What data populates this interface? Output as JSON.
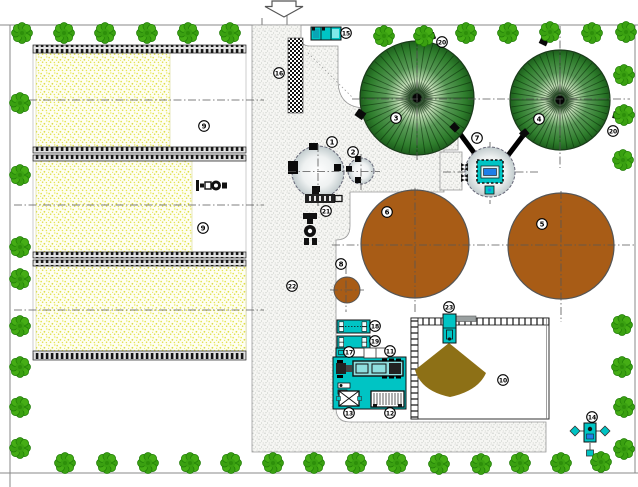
{
  "plan": {
    "title": "biogas-plant-site-plan",
    "entrance_arrow": {
      "icon": "down-arrow"
    },
    "markers": [
      {
        "n": "1",
        "x": 332,
        "y": 142
      },
      {
        "n": "2",
        "x": 353,
        "y": 152
      },
      {
        "n": "3",
        "x": 396,
        "y": 118
      },
      {
        "n": "4",
        "x": 539,
        "y": 119
      },
      {
        "n": "5",
        "x": 542,
        "y": 224
      },
      {
        "n": "6",
        "x": 387,
        "y": 212
      },
      {
        "n": "7",
        "x": 477,
        "y": 138
      },
      {
        "n": "8",
        "x": 341,
        "y": 264
      },
      {
        "n": "9",
        "x": 204,
        "y": 126
      },
      {
        "n": "9",
        "x": 203,
        "y": 228
      },
      {
        "n": "10",
        "x": 503,
        "y": 380
      },
      {
        "n": "11",
        "x": 390,
        "y": 351
      },
      {
        "n": "12",
        "x": 390,
        "y": 413
      },
      {
        "n": "13",
        "x": 349,
        "y": 413
      },
      {
        "n": "14",
        "x": 592,
        "y": 417
      },
      {
        "n": "15",
        "x": 346,
        "y": 33
      },
      {
        "n": "16",
        "x": 279,
        "y": 73
      },
      {
        "n": "17",
        "x": 349,
        "y": 352
      },
      {
        "n": "18",
        "x": 375,
        "y": 326
      },
      {
        "n": "19",
        "x": 375,
        "y": 341
      },
      {
        "n": "20",
        "x": 442,
        "y": 42
      },
      {
        "n": "20",
        "x": 613,
        "y": 131
      },
      {
        "n": "21",
        "x": 326,
        "y": 211
      },
      {
        "n": "22",
        "x": 292,
        "y": 286
      },
      {
        "n": "23",
        "x": 449,
        "y": 307
      }
    ],
    "digesters": [
      {
        "cx": 417,
        "cy": 98,
        "r": 57
      },
      {
        "cx": 560,
        "cy": 100,
        "r": 50
      }
    ],
    "trees": [
      [
        22,
        33
      ],
      [
        64,
        33
      ],
      [
        105,
        33
      ],
      [
        147,
        33
      ],
      [
        188,
        33
      ],
      [
        230,
        33
      ],
      [
        384,
        36
      ],
      [
        424,
        36
      ],
      [
        466,
        33
      ],
      [
        508,
        33
      ],
      [
        550,
        32
      ],
      [
        592,
        33
      ],
      [
        626,
        32
      ],
      [
        20,
        103
      ],
      [
        20,
        175
      ],
      [
        20,
        247
      ],
      [
        20,
        279
      ],
      [
        20,
        326
      ],
      [
        20,
        367
      ],
      [
        20,
        407
      ],
      [
        20,
        448
      ],
      [
        65,
        463
      ],
      [
        107,
        463
      ],
      [
        148,
        463
      ],
      [
        190,
        463
      ],
      [
        231,
        463
      ],
      [
        273,
        463
      ],
      [
        314,
        463
      ],
      [
        356,
        463
      ],
      [
        397,
        463
      ],
      [
        439,
        464
      ],
      [
        481,
        464
      ],
      [
        520,
        463
      ],
      [
        561,
        463
      ],
      [
        601,
        462
      ],
      [
        624,
        449
      ],
      [
        624,
        75
      ],
      [
        624,
        115
      ],
      [
        623,
        160
      ],
      [
        622,
        325
      ],
      [
        622,
        367
      ],
      [
        624,
        407
      ]
    ],
    "colors": {
      "tree_green": "#3aa011",
      "digester_green_dark": "#1d5e1c",
      "digester_green_light": "#c9e2bd",
      "tank_brown": "#a85c16",
      "equipment_cyan": "#00c4c4",
      "accent_blue": "#1f7fe8",
      "silage_yellow": "#e4e44e",
      "pile_olive": "#8d7016",
      "road_stipple": "#b4bab4",
      "boundary_gray": "#888888"
    }
  }
}
